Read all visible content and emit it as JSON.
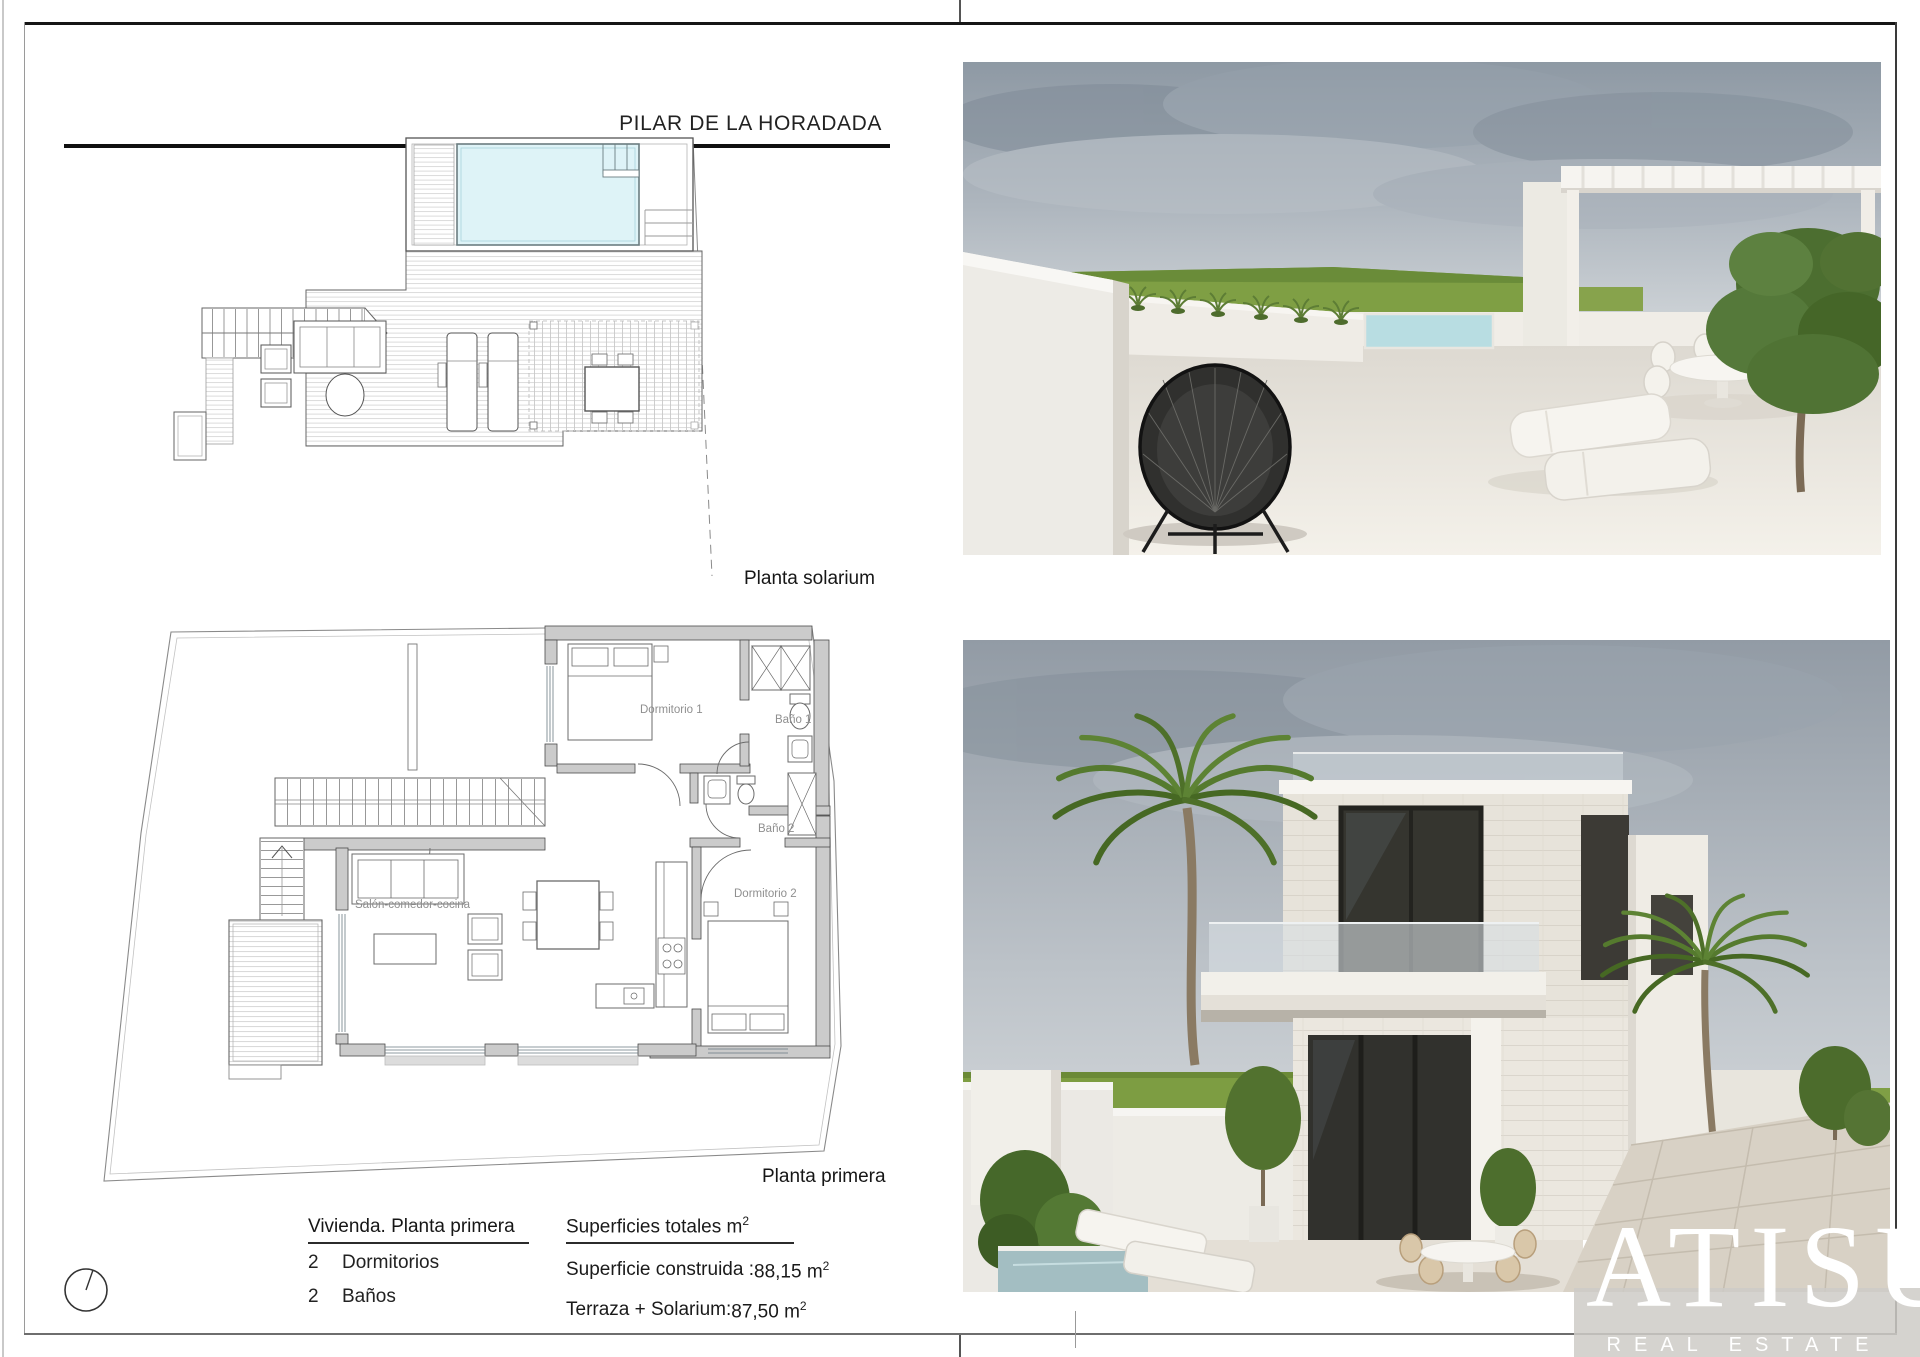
{
  "page": {
    "title": "PILAR DE LA HORADADA"
  },
  "solarium_plan": {
    "caption": "Planta solarium"
  },
  "first_floor_plan": {
    "caption": "Planta primera",
    "labels": {
      "bedroom1": "Dormitorio 1",
      "bath1": "Baño 1",
      "bath2": "Baño 2",
      "bedroom2": "Dormitorio 2",
      "living": "Salón-comedor-cocina"
    }
  },
  "details": {
    "dwelling_heading": "Vivienda. Planta primera",
    "features": [
      {
        "qty": "2",
        "label": "Dormitorios"
      },
      {
        "qty": "2",
        "label": "Baños"
      }
    ],
    "surfaces_heading": "Superficies totales m",
    "sup": "2",
    "surfaces": [
      {
        "label": "Superficie construida :",
        "value": "88,15 m"
      },
      {
        "label": "Terraza + Solarium:",
        "value": "87,50 m"
      }
    ]
  },
  "brand": {
    "name": "ATISÚ",
    "tagline": "REAL ESTATE"
  },
  "colors": {
    "pool_water": "#def3f7",
    "wall_gray": "#cbcbcb",
    "sky": "#929ba5",
    "grass": "#7d9d42"
  }
}
